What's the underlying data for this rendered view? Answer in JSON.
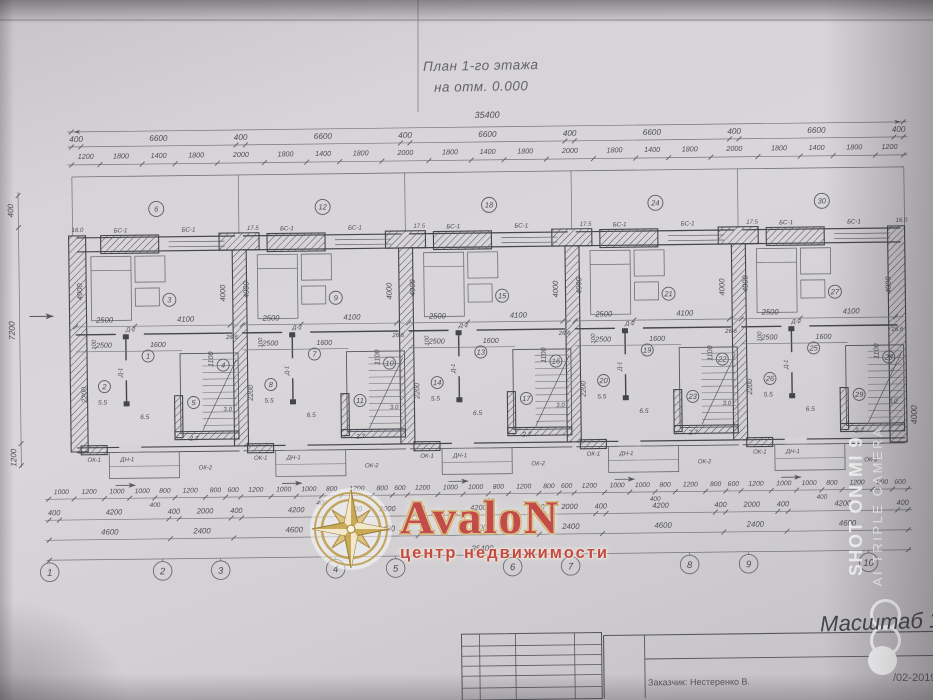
{
  "title": {
    "line1": "План 1-го этажа",
    "line2": "на отм. 0.000"
  },
  "dims_top": {
    "total": "35400",
    "row2": [
      "400",
      "6600",
      "400",
      "6600",
      "400",
      "6600",
      "400",
      "6600",
      "400",
      "6600",
      "400"
    ],
    "row3": [
      "1200",
      "1800",
      "1400",
      "1800",
      "2000",
      "1800",
      "1400",
      "1800",
      "2000",
      "1800",
      "1400",
      "1800",
      "2000",
      "1800",
      "1400",
      "1800",
      "2000",
      "1800",
      "1400",
      "1800",
      "1200"
    ]
  },
  "dims_bottom": {
    "row1": [
      "1000",
      "1200",
      "1000",
      "1000",
      "800",
      "1200",
      "800",
      "600",
      "1200",
      "1000",
      "1000",
      "800",
      "1200",
      "800",
      "600",
      "1200",
      "1000",
      "1000",
      "800",
      "1200",
      "800",
      "600",
      "1200",
      "1000",
      "1000",
      "800",
      "1200",
      "800",
      "600",
      "1200",
      "1000",
      "1000",
      "800",
      "1200",
      "800",
      "600"
    ],
    "row1_sub": "400",
    "row2": [
      "400",
      "4200",
      "400",
      "2000",
      "400",
      "4200",
      "400",
      "2000",
      "400",
      "4200",
      "400",
      "2000",
      "400",
      "4200",
      "400",
      "2000",
      "400",
      "4200",
      "400"
    ],
    "row3": [
      "4600",
      "2400",
      "4600",
      "2400",
      "4600",
      "2400",
      "4600",
      "2400",
      "4600"
    ],
    "total": "35400"
  },
  "axes": [
    "1",
    "2",
    "3",
    "4",
    "5",
    "6",
    "7",
    "8",
    "9",
    "10"
  ],
  "axis_x": [
    47,
    160,
    218,
    333,
    393,
    510,
    568,
    687,
    746,
    866
  ],
  "side_left": [
    "400",
    "7200",
    "1200"
  ],
  "side_right": "4000",
  "units": [
    {
      "terrace": "6",
      "hall": "1",
      "room": "2",
      "living": "3",
      "small": "4",
      "stairs": "5"
    },
    {
      "terrace": "12",
      "hall": "7",
      "room": "8",
      "living": "9",
      "small": "10",
      "stairs": "11"
    },
    {
      "terrace": "18",
      "hall": "13",
      "room": "14",
      "living": "15",
      "small": "16",
      "stairs": "17"
    },
    {
      "terrace": "24",
      "hall": "19",
      "room": "20",
      "living": "21",
      "small": "22",
      "stairs": "23"
    },
    {
      "terrace": "30",
      "hall": "25",
      "room": "26",
      "living": "27",
      "small": "28",
      "stairs": "29"
    }
  ],
  "unit_labels": {
    "bs": "БС-1",
    "d1": "Д-1",
    "d2": "Д-2",
    "dn": "ДН-1",
    "ok1": "ОК-1",
    "ok2": "ОК-2",
    "dim_2500": "2500",
    "dim_4100": "4100",
    "dim_1600": "1600",
    "dim_4900": "4900",
    "dim_4000": "4000",
    "dim_2200": "2200",
    "dim_1100": "1100",
    "dim_100": "100",
    "area_room": "5.5",
    "area_hall": "6.5",
    "area_stairs": "2.7",
    "area_small": "3.0",
    "area_living": "26.6",
    "corner_t": "17.5",
    "corner_end": "16.0"
  },
  "watermark": {
    "brand": "AvaloN",
    "sub": "центр недвижимости",
    "brand_color": "#c34543",
    "gold": "#c9a852"
  },
  "camera_watermark": {
    "line1": "SHOT ON MI 9",
    "line2": "AI TRIPLE CAMERA"
  },
  "titleblock": {
    "scale": "Масштаб 1:",
    "doc": "/02-2019",
    "client": "Заказчик: Нестеренко В."
  }
}
